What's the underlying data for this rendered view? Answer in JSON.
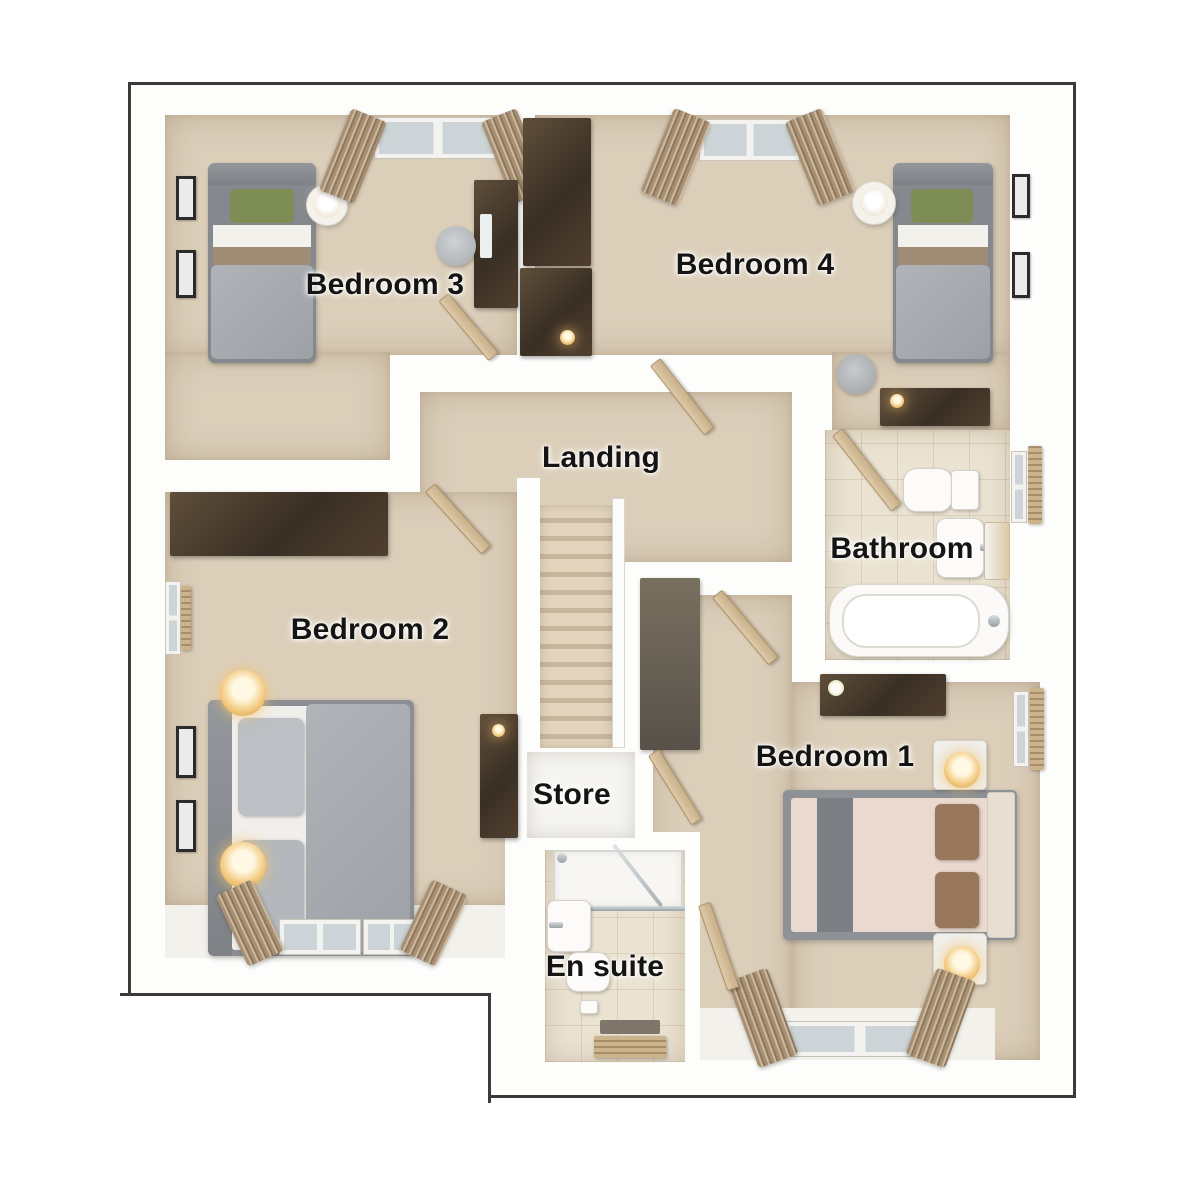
{
  "figure_type": "floor-plan",
  "floor": {
    "rooms": [
      {
        "key": "bedroom3",
        "label": "Bedroom 3"
      },
      {
        "key": "bedroom4",
        "label": "Bedroom 4"
      },
      {
        "key": "landing",
        "label": "Landing"
      },
      {
        "key": "bathroom",
        "label": "Bathroom"
      },
      {
        "key": "bedroom2",
        "label": "Bedroom 2"
      },
      {
        "key": "store",
        "label": "Store"
      },
      {
        "key": "bedroom1",
        "label": "Bedroom 1"
      },
      {
        "key": "ensuite",
        "label": "En suite"
      }
    ]
  },
  "theme": {
    "outline": "#3a3a38",
    "wall": "#fdfdfc",
    "carpet": "#dccfba",
    "tile": "#ebe3d2",
    "store_floor": "#f6f5f1",
    "wood_dark": "#4a3c2e",
    "wood_mid": "#6b6257",
    "wood_door": "#d3bd9b",
    "bed_grey": "#a7abb0",
    "bed_taupe": "#a08b74",
    "pillow_green": "#7e8d55",
    "mattress_pink": "#ead9ce",
    "pillow_brown": "#99775b",
    "curtain": "#a18a71",
    "lamp_gold": "#eebe6a",
    "label_color": "#141414"
  }
}
